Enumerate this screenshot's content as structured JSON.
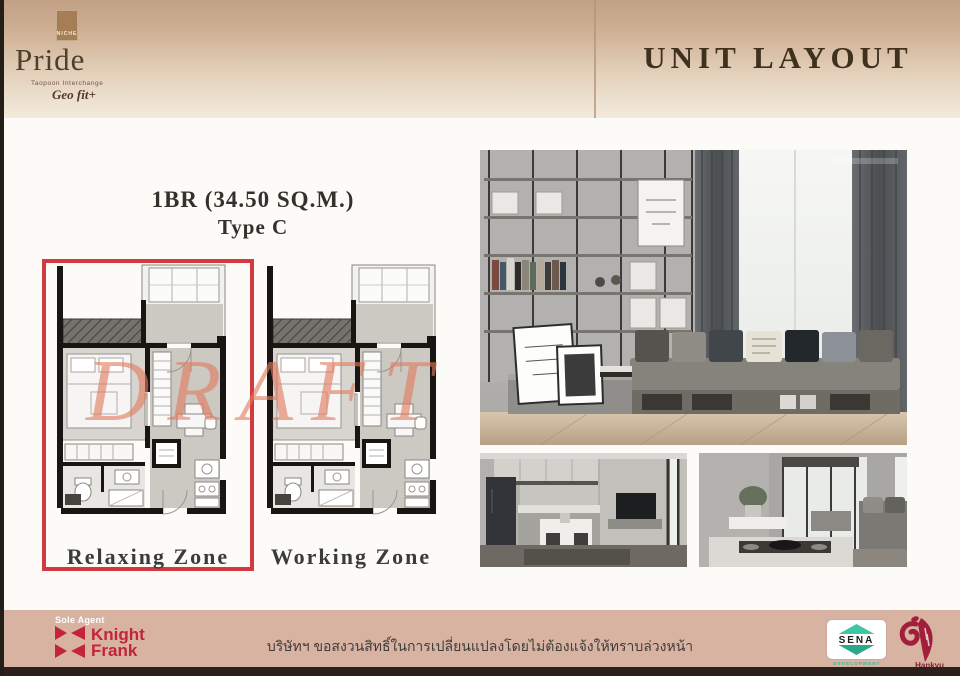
{
  "header": {
    "brand": {
      "badge": "NICHE",
      "name": "Pride",
      "subtitle": "Taopoon Interchange",
      "tagline": "Geo fit+"
    },
    "title": "UNIT LAYOUT"
  },
  "plans": {
    "heading": {
      "size_line": "1BR  (34.50 SQ.M.)",
      "type_line": "Type C"
    },
    "watermark": "DRAFT",
    "items": [
      {
        "label": "Relaxing Zone",
        "highlighted": true
      },
      {
        "label": "Working Zone",
        "highlighted": false
      }
    ]
  },
  "footer": {
    "sole_agent_label": "Sole Agent",
    "knight_frank": {
      "word1": "Knight",
      "word2": "Frank"
    },
    "disclaimer": "บริษัทฯ ขอสงวนสิทธิ์ในการเปลี่ยนแปลงโดยไม่ต้องแจ้งให้ทราบล่วงหน้า",
    "sena": {
      "name": "SENA",
      "subtitle": "DEVELOPMENT"
    },
    "hankyu": {
      "label": "Hankyu"
    }
  },
  "colors": {
    "highlight_red": "#d23a3f",
    "watermark_salmon": "#e27c5f",
    "footer_bg": "#d9b3a2",
    "knight_frank_red": "#c32438",
    "sena_teal": "#2fb99a",
    "hankyu_crimson": "#a21f3c",
    "title_brown": "#40311f",
    "header_gradient_top": "#c2a084",
    "header_gradient_bottom": "#f3ebdc"
  }
}
